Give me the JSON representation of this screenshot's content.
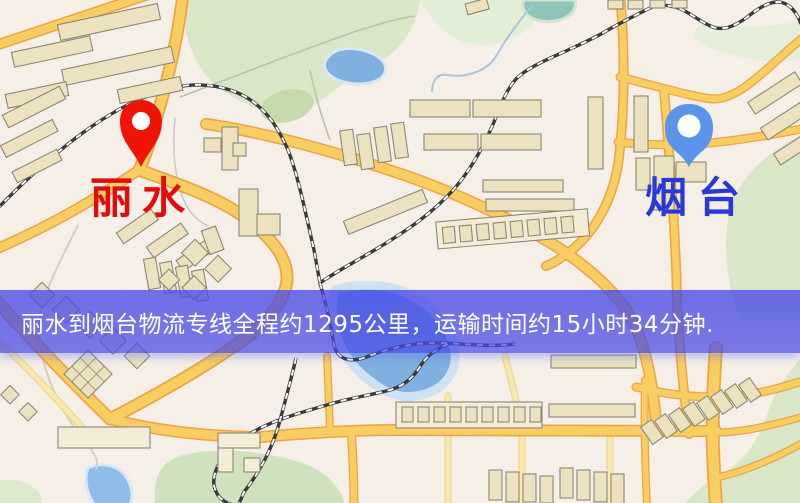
{
  "map": {
    "origin": {
      "label": "丽水",
      "marker_color": "#ee1507",
      "label_color": "#e10d0d"
    },
    "destination": {
      "label": "烟台",
      "marker_color": "#5a94ea",
      "label_color": "#2a38d8"
    },
    "banner": {
      "text": "丽水到烟台物流专线全程约1295公里，运输时间约15小时34分钟.",
      "background_color": "#484ae6",
      "text_color": "#ffffff"
    },
    "route_info": {
      "distance_km": "1295",
      "duration": "15小时34分钟"
    },
    "palette": {
      "map_background": "#f6efe7",
      "road_fill": "#f8cd62",
      "road_casing": "#eaa544",
      "park_green": "#d9e7c8",
      "water_blue": "#7fb0e0",
      "railway": "#3a3a3a"
    }
  }
}
